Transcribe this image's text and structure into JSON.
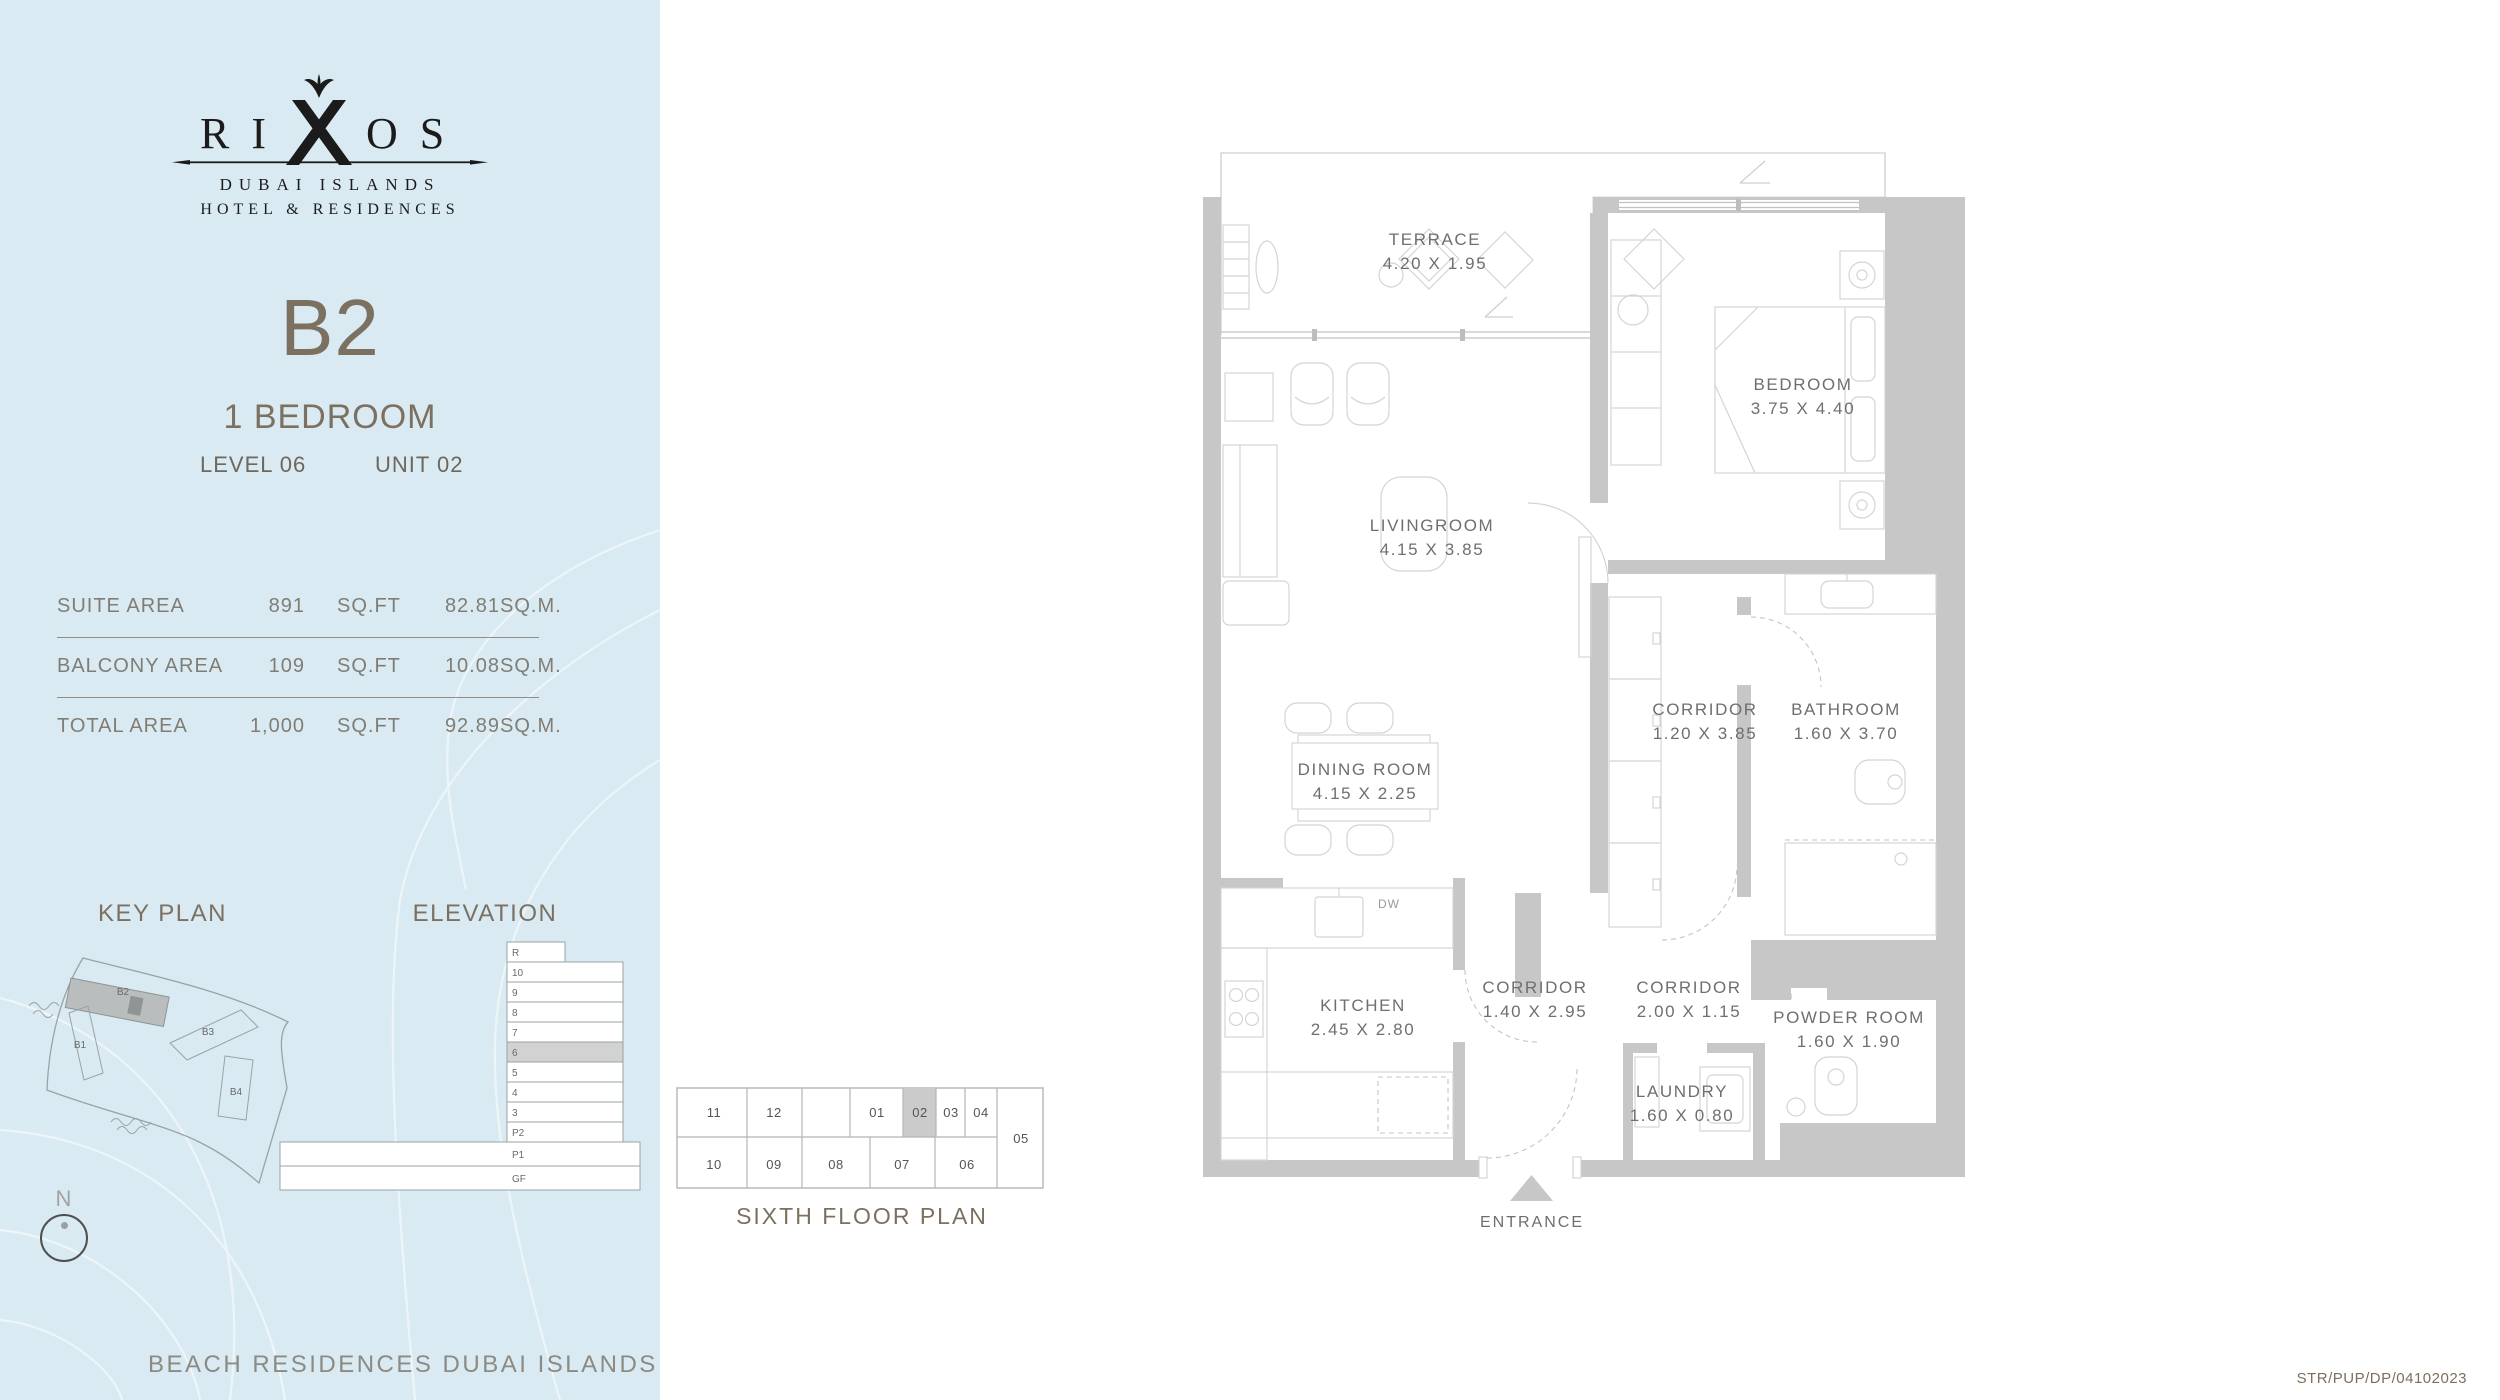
{
  "brand": {
    "wordmark_left": "RI",
    "wordmark_right": "OS",
    "line1": "DUBAI ISLANDS",
    "line2": "HOTEL & RESIDENCES"
  },
  "unit": {
    "code": "B2",
    "type": "1 BEDROOM",
    "level": "LEVEL 06",
    "unit": "UNIT 02"
  },
  "area_table": {
    "rows": [
      {
        "label": "SUITE AREA",
        "sqft": "891",
        "sqft_unit": "SQ.FT",
        "sqm": "82.81",
        "sqm_unit": "SQ.M."
      },
      {
        "label": "BALCONY AREA",
        "sqft": "109",
        "sqft_unit": "SQ.FT",
        "sqm": "10.08",
        "sqm_unit": "SQ.M."
      },
      {
        "label": "TOTAL AREA",
        "sqft": "1,000",
        "sqft_unit": "SQ.FT",
        "sqm": "92.89",
        "sqm_unit": "SQ.M."
      }
    ]
  },
  "key_plan": {
    "title": "KEY PLAN",
    "b1": "B1",
    "b2": "B2",
    "b3": "B3",
    "b4": "B4"
  },
  "elevation": {
    "title": "ELEVATION",
    "floors": [
      "R",
      "10",
      "9",
      "8",
      "7",
      "6",
      "5",
      "4",
      "3",
      "P2",
      "P1",
      "GF"
    ]
  },
  "floor_key": {
    "caption": "SIXTH FLOOR PLAN",
    "u11": "11",
    "u12": "12",
    "u01": "01",
    "u02": "02",
    "u03": "03",
    "u04": "04",
    "u05": "05",
    "u06": "06",
    "u07": "07",
    "u08": "08",
    "u09": "09",
    "u10": "10"
  },
  "plan": {
    "rooms": [
      {
        "name": "TERRACE",
        "dims": "4.20 X 1.95"
      },
      {
        "name": "BEDROOM",
        "dims": "3.75 X 4.40"
      },
      {
        "name": "LIVINGROOM",
        "dims": "4.15 X 3.85"
      },
      {
        "name": "CORRIDOR",
        "dims": "1.20 X 3.85"
      },
      {
        "name": "BATHROOM",
        "dims": "1.60 X 3.70"
      },
      {
        "name": "DINING ROOM",
        "dims": "4.15 X 2.25"
      },
      {
        "name": "KITCHEN",
        "dims": "2.45 X 2.80"
      },
      {
        "name": "CORRIDOR",
        "dims": "1.40 X 2.95"
      },
      {
        "name": "CORRIDOR",
        "dims": "2.00 X 1.15"
      },
      {
        "name": "POWDER ROOM",
        "dims": "1.60 X 1.90"
      },
      {
        "name": "LAUNDRY",
        "dims": "1.60 X 0.80"
      }
    ],
    "dw": "DW",
    "entrance": "ENTRANCE"
  },
  "compass": {
    "n": "N"
  },
  "footer": {
    "tagline": "BEACH RESIDENCES DUBAI ISLANDS",
    "code": "STR/PUP/DP/04102023"
  },
  "colors": {
    "panel_bg": "#d9eaf2",
    "accent_brown": "#7c7161",
    "wall_gray": "#c7c7c7",
    "highlight_gray": "#cbcbcb",
    "logo_black": "#1b1b1b"
  }
}
